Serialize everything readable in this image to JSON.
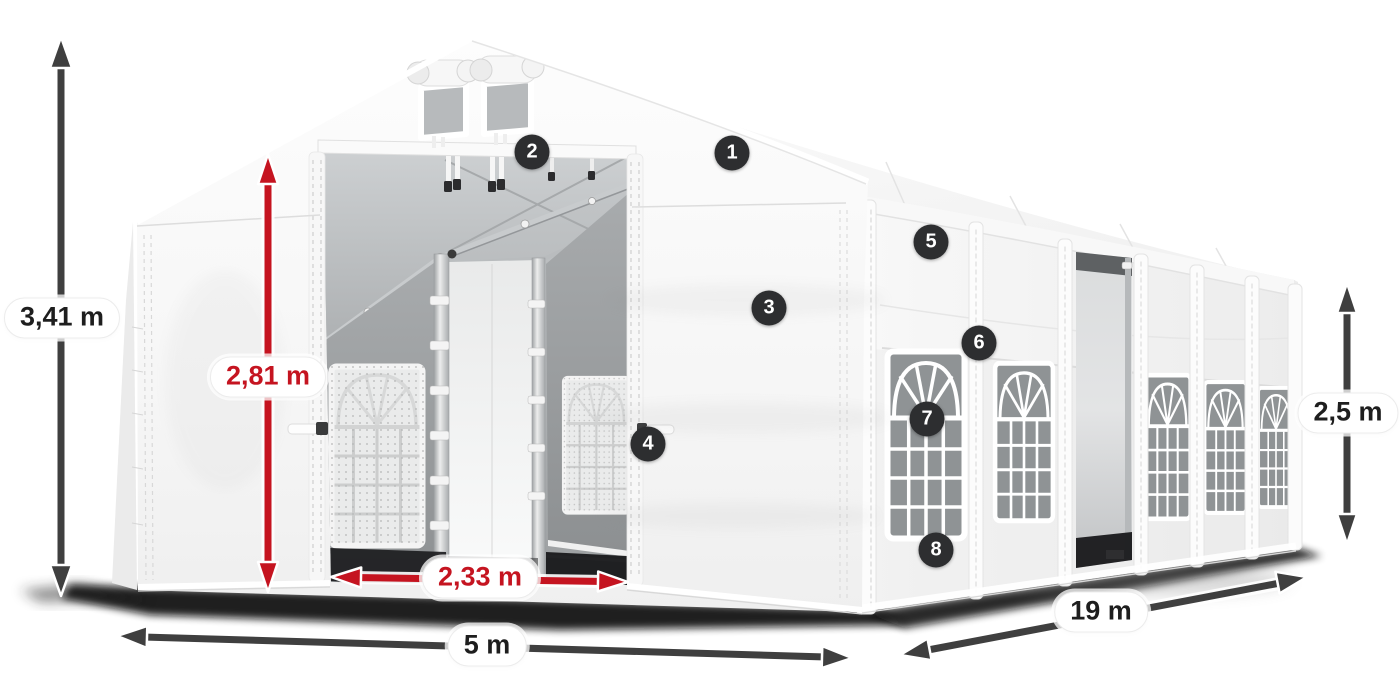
{
  "diagram": {
    "subject": "tent-dimension-diagram",
    "colors": {
      "dimension_red": "#c51420",
      "dimension_dark": "#3f3f3f",
      "marker_background": "#2d2e30",
      "pill_background": "#ffffff",
      "tent_fabric": "#f6f6f6"
    },
    "dimensions": {
      "total_height": {
        "value": "3,41 m",
        "style": "dark"
      },
      "inner_height": {
        "value": "2,81 m",
        "style": "red"
      },
      "entrance_width": {
        "value": "2,33 m",
        "style": "red"
      },
      "tent_width": {
        "value": "5 m",
        "style": "dark"
      },
      "tent_length": {
        "value": "19 m",
        "style": "dark"
      },
      "side_height": {
        "value": "2,5 m",
        "style": "dark"
      }
    },
    "markers": [
      {
        "number": "1"
      },
      {
        "number": "2"
      },
      {
        "number": "3"
      },
      {
        "number": "4"
      },
      {
        "number": "5"
      },
      {
        "number": "6"
      },
      {
        "number": "7"
      },
      {
        "number": "8"
      }
    ]
  }
}
